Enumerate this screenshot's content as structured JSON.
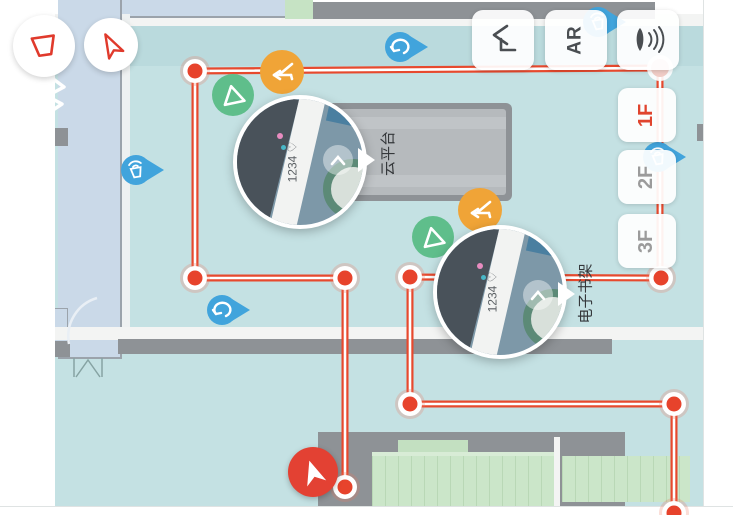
{
  "controls": {
    "top_right": [
      {
        "name": "reroute-button",
        "icon": "step-back-arrow-icon"
      },
      {
        "name": "ar-mode-button",
        "label": "AR"
      },
      {
        "name": "voice-button",
        "icon": "voice-wave-icon"
      }
    ],
    "top_left": [
      {
        "name": "region-tool-button",
        "icon": "trapezoid-icon"
      },
      {
        "name": "navigate-tool-button",
        "icon": "nav-arrow-outline-icon"
      }
    ],
    "floors": [
      {
        "label": "1F",
        "active": true
      },
      {
        "label": "2F",
        "active": false
      },
      {
        "label": "3F",
        "active": false
      }
    ]
  },
  "map": {
    "pois": [
      {
        "label": "云平台"
      },
      {
        "label": "电子书架"
      }
    ],
    "bubbles": [
      {
        "caption": "1234 ♡"
      },
      {
        "caption": "1234 ♡"
      }
    ],
    "pins": [
      {
        "icon": "beacon-icon"
      },
      {
        "icon": "loop-arrow-icon"
      },
      {
        "icon": "loop-arrow-icon"
      },
      {
        "icon": "beacon-icon"
      },
      {
        "icon": "beacon-icon"
      }
    ],
    "markers": [
      {
        "icon": "triangle-icon",
        "color": "#5fbe8b"
      },
      {
        "icon": "turn-arrow-icon",
        "color": "#f0a437"
      }
    ]
  },
  "colors": {
    "floor_teal": "#c4e1e3",
    "room_blue": "#cad9e8",
    "wall_gray": "#8e9296",
    "table_gray": "#b6babd",
    "shelf_green": "#cbe6c9",
    "route_red": "#e7492e",
    "pin_blue": "#41a4dc",
    "marker_orange": "#f0a437",
    "marker_green": "#5fbe8b",
    "active_floor_red": "#e0442e",
    "inactive_floor_gray": "#9b9b9b"
  }
}
